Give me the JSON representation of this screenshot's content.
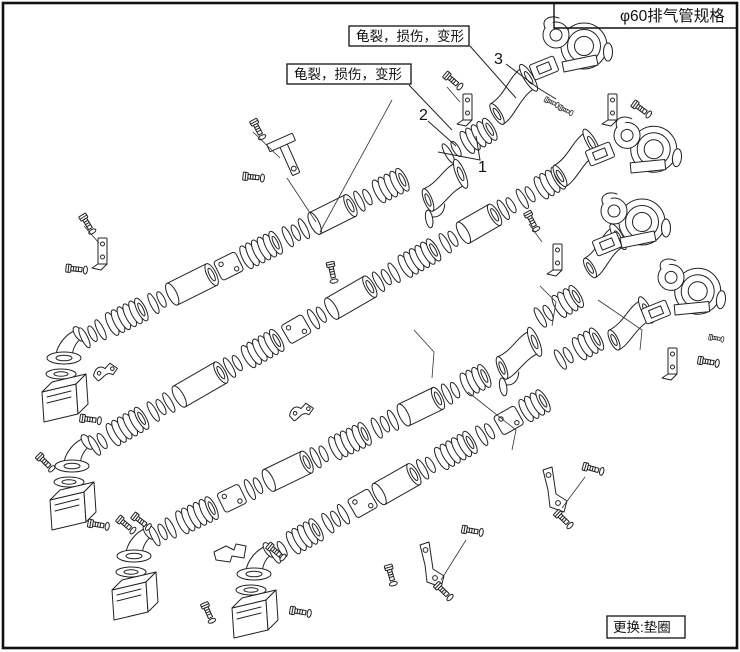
{
  "header": {
    "spec_label": "φ60排气管规格"
  },
  "callouts": {
    "top": "龟裂，损伤，变形",
    "bottom": "龟裂，损伤，变形"
  },
  "part_numbers": {
    "n1": "1",
    "n2": "2",
    "n3": "3"
  },
  "footer": {
    "replace_label": "更换:垫圈"
  },
  "colors": {
    "line": "#222222",
    "background": "#ffffff",
    "frame": "#111111"
  }
}
